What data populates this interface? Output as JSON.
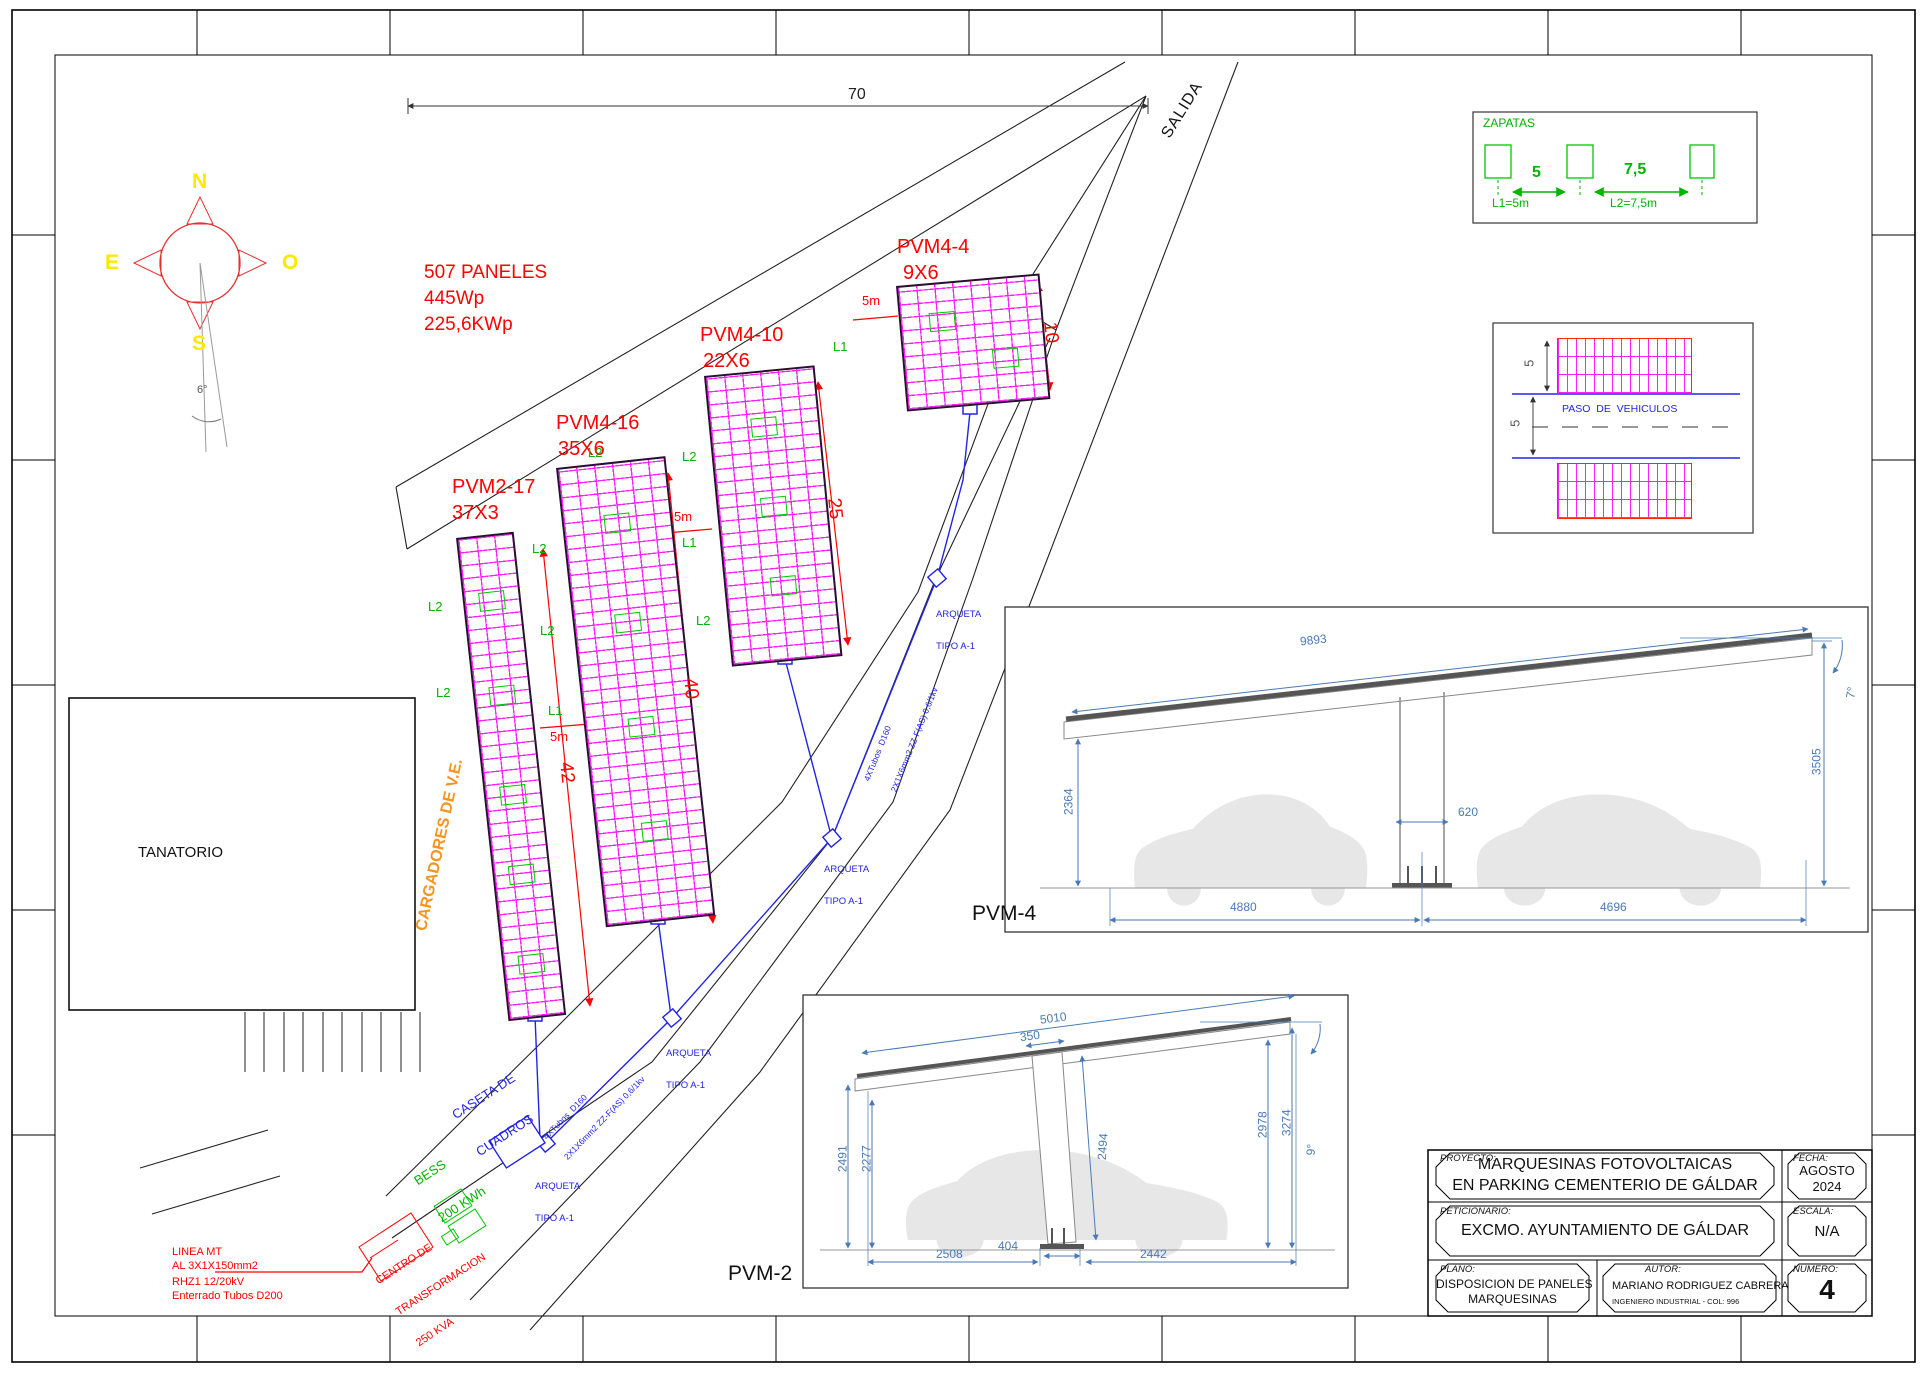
{
  "compass": {
    "n": "N",
    "e": "E",
    "o": "O",
    "s": "S",
    "angle": "6°"
  },
  "summary": {
    "line1": "507 PANELES",
    "line2": "445Wp",
    "line3": "225,6KWp"
  },
  "site": {
    "dim_top": "70",
    "salida": "SALIDA",
    "tanatorio": "TANATORIO",
    "cargadores": "CARGADORES DE V.E.",
    "l1": "L1",
    "l2": "L2",
    "five_m": "5m",
    "pvm4_section": "PVM-4",
    "pvm2_section": "PVM-2"
  },
  "arrays": [
    {
      "name": "PVM2-17",
      "size": "37X3",
      "length_dim": "42"
    },
    {
      "name": "PVM4-16",
      "size": "35X6",
      "length_dim": "40"
    },
    {
      "name": "PVM4-10",
      "size": "22X6",
      "length_dim": "25"
    },
    {
      "name": "PVM4-4",
      "size": "9X6",
      "length_dim": "10"
    }
  ],
  "cable": {
    "arqueta_line1": "ARQUETA",
    "arqueta_line2": "TIPO A-1",
    "tubes": "4XTubos  D160",
    "circuit": "2X1X6mm2 ZZ-F(AS) 0,6/1kv",
    "caseta_line1": "CASETA DE",
    "caseta_line2": "CUADROS",
    "bess_line1": "BESS",
    "bess_line2": "200 KWh"
  },
  "mt": {
    "line1": "LINEA MT",
    "line2": "AL 3X1X150mm2",
    "line3": "RHZ1 12/20kV",
    "line4": "Enterrado Tubos D200",
    "ct_line1": "CENTRO DE",
    "ct_line2": "TRANSFORMACION",
    "ct_line3": "250 KVA"
  },
  "zapatas": {
    "title": "ZAPATAS",
    "dim1": "5",
    "dim2": "7,5",
    "label1": "L1=5m",
    "label2": "L2=7,5m"
  },
  "paso": {
    "label": "PASO  DE  VEHICULOS",
    "dim_top": "5",
    "dim_lane": "5"
  },
  "pvm4_detail": {
    "roof": "9893",
    "height_left": "2364",
    "column_width": "620",
    "span_left": "4880",
    "span_right": "4696",
    "height_right": "3505",
    "angle": "7°"
  },
  "pvm2_detail": {
    "roof": "5010",
    "column_top": "350",
    "height_left_outer": "2491",
    "height_left_inner": "2277",
    "column_length": "2494",
    "height_right_inner": "2978",
    "height_right_outer": "3274",
    "angle": "9°",
    "base_left": "2508",
    "base_center": "404",
    "base_right": "2442"
  },
  "titleblock": {
    "proyecto_label": "PROYECTO:",
    "proyecto_line1": "MARQUESINAS FOTOVOLTAICAS",
    "proyecto_line2": "EN PARKING CEMENTERIO DE GÁLDAR",
    "fecha_label": "FECHA:",
    "fecha_line1": "AGOSTO",
    "fecha_line2": "2024",
    "peticionario_label": "PETICIONARIO:",
    "peticionario_value": "EXCMO. AYUNTAMIENTO DE GÁLDAR",
    "escala_label": "ESCALA:",
    "escala_value": "N/A",
    "plano_label": "PLANO:",
    "plano_line1": "DISPOSICION DE PANELES",
    "plano_line2": "MARQUESINAS",
    "autor_label": "AUTOR:",
    "autor_name": "MARIANO RODRIGUEZ CABRERA",
    "autor_title": "INGENIERO INDUSTRIAL - COL: 996",
    "numero_label": "NUMERO:",
    "numero_value": "4"
  },
  "colors": {
    "red": "#FF0000",
    "magenta": "#FF00FF",
    "green": "#00C800",
    "blue": "#2323E8",
    "yellow": "#FFE800",
    "orange": "#F7941D",
    "dim_blue": "#4A7AB5"
  }
}
